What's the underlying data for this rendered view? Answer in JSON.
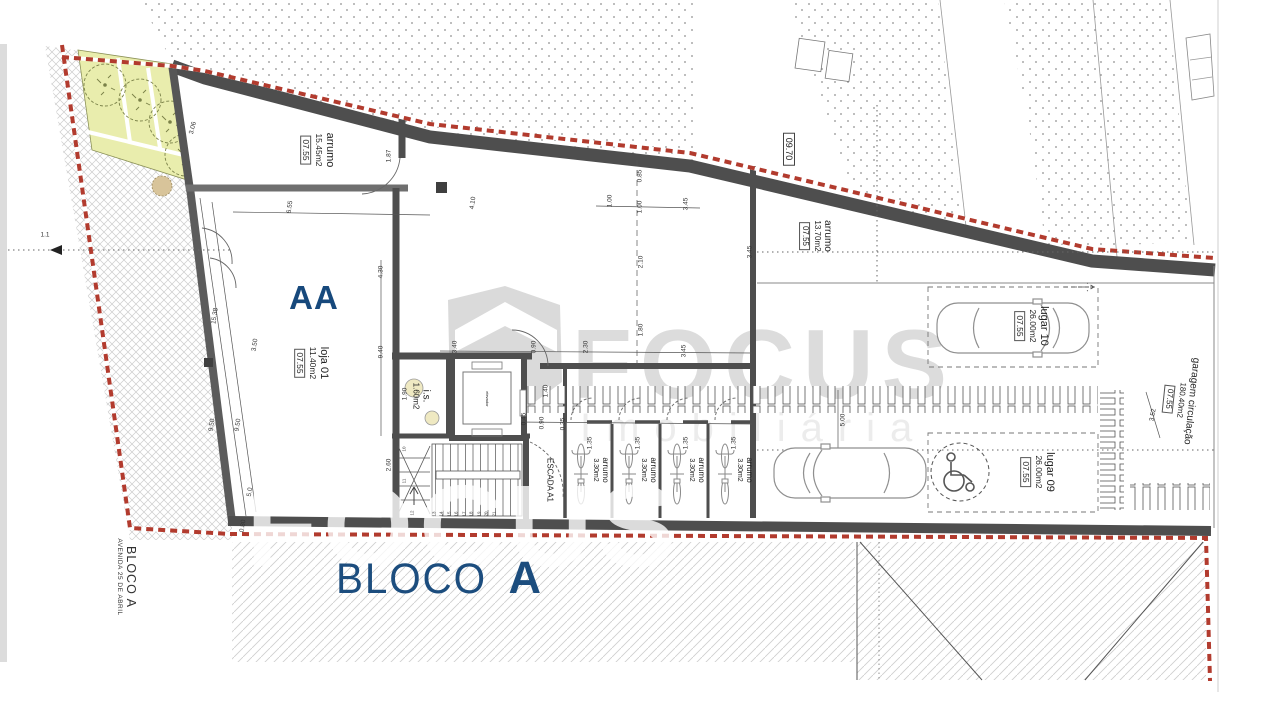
{
  "labels": {
    "block_marker": "AA",
    "bloco": {
      "word": "BLOCO",
      "letter": "A"
    },
    "street_vertical": {
      "line1": "BLOCO A",
      "line2": "AVENIDA 25 DE ABRIL"
    },
    "level_box": "09.70",
    "street_ref": "1.1"
  },
  "rooms": {
    "storage_top_left": {
      "name": "arrumo",
      "area": "15.45m2",
      "code": "07.55"
    },
    "shop": {
      "name": "loja 01",
      "area": "11.40m2",
      "code": "07.55"
    },
    "wc": {
      "name": "i.s.",
      "area": "1.60m2"
    },
    "elevator": {
      "name": "elevador"
    },
    "stairs": {
      "name": "ESCADA A1"
    },
    "storage_right": {
      "name": "arrumo",
      "area": "13.70m2",
      "code": "07.55"
    },
    "bike_storage": [
      {
        "name": "arrumo",
        "area": "3.30m2"
      },
      {
        "name": "arrumo",
        "area": "3.30m2"
      },
      {
        "name": "arrumo",
        "area": "3.30m2"
      },
      {
        "name": "arrumo",
        "area": "3.30m2"
      }
    ],
    "parking_10": {
      "name": "lugar 10",
      "area": "26.00m2",
      "code": "07.55"
    },
    "parking_09": {
      "name": "lugar 09",
      "area": "26.00m2",
      "code": "07.55"
    },
    "garage": {
      "name": "garagem circulação",
      "area": "180.40m2",
      "code": "07.55"
    }
  },
  "watermark": {
    "brand": "FOCUS",
    "tagline": "Imobiliária"
  },
  "dimensions": [
    {
      "t": "3.06",
      "x": 193,
      "y": 128,
      "r": -76
    },
    {
      "t": "6.55",
      "x": 290,
      "y": 207,
      "r": -82
    },
    {
      "t": "4.10",
      "x": 473,
      "y": 203,
      "r": -82
    },
    {
      "t": "1.87",
      "x": 389,
      "y": 156,
      "r": -90
    },
    {
      "t": "0.85",
      "x": 640,
      "y": 176,
      "r": -90
    },
    {
      "t": "1.00",
      "x": 610,
      "y": 201,
      "r": -90
    },
    {
      "t": "1.00",
      "x": 640,
      "y": 207,
      "r": -90
    },
    {
      "t": "3.45",
      "x": 686,
      "y": 204,
      "r": -90
    },
    {
      "t": "2.10",
      "x": 641,
      "y": 262,
      "r": -90
    },
    {
      "t": "1.80",
      "x": 641,
      "y": 330,
      "r": -90
    },
    {
      "t": "3.45",
      "x": 750,
      "y": 252,
      "r": -90
    },
    {
      "t": "4.30",
      "x": 381,
      "y": 272,
      "r": -90
    },
    {
      "t": "9.40",
      "x": 381,
      "y": 352,
      "r": -90
    },
    {
      "t": "3.40",
      "x": 455,
      "y": 347,
      "r": -90
    },
    {
      "t": "0.90",
      "x": 534,
      "y": 347,
      "r": -90
    },
    {
      "t": "2.30",
      "x": 586,
      "y": 347,
      "r": -90
    },
    {
      "t": "3.45",
      "x": 684,
      "y": 351,
      "r": -90
    },
    {
      "t": "1.90",
      "x": 405,
      "y": 394,
      "r": -90
    },
    {
      "t": "1.40",
      "x": 546,
      "y": 391,
      "r": -90
    },
    {
      "t": "0.45",
      "x": 524,
      "y": 419,
      "r": -90
    },
    {
      "t": "0.90",
      "x": 542,
      "y": 423,
      "r": -90
    },
    {
      "t": "0.35",
      "x": 563,
      "y": 424,
      "r": -90
    },
    {
      "t": "1.35",
      "x": 590,
      "y": 443,
      "r": -90
    },
    {
      "t": "1.35",
      "x": 638,
      "y": 443,
      "r": -90
    },
    {
      "t": "1.35",
      "x": 686,
      "y": 443,
      "r": -90
    },
    {
      "t": "1.35",
      "x": 734,
      "y": 443,
      "r": -90
    },
    {
      "t": "2.60",
      "x": 389,
      "y": 465,
      "r": -90
    },
    {
      "t": "15.38",
      "x": 215,
      "y": 316,
      "r": -81
    },
    {
      "t": "9.50",
      "x": 212,
      "y": 425,
      "r": -81
    },
    {
      "t": "9.50",
      "x": 238,
      "y": 425,
      "r": -81
    },
    {
      "t": "3.50",
      "x": 255,
      "y": 345,
      "r": -81
    },
    {
      "t": "5.0",
      "x": 250,
      "y": 492,
      "r": -81
    },
    {
      "t": "0.80",
      "x": 243,
      "y": 526,
      "r": -81
    },
    {
      "t": "5.00",
      "x": 843,
      "y": 420,
      "r": -90
    },
    {
      "t": "3.52",
      "x": 1153,
      "y": 415,
      "r": -80
    }
  ],
  "stair_steps": [
    {
      "n": "10",
      "x": 404,
      "y": 449
    },
    {
      "n": "11",
      "x": 404,
      "y": 481
    },
    {
      "n": "12",
      "x": 412,
      "y": 513
    },
    {
      "n": "13",
      "x": 434,
      "y": 514
    },
    {
      "n": "14",
      "x": 441,
      "y": 514
    },
    {
      "n": "15",
      "x": 449,
      "y": 514
    },
    {
      "n": "16",
      "x": 456,
      "y": 514
    },
    {
      "n": "17",
      "x": 464,
      "y": 514
    },
    {
      "n": "18",
      "x": 471,
      "y": 514
    },
    {
      "n": "19",
      "x": 479,
      "y": 514
    },
    {
      "n": "20",
      "x": 486,
      "y": 514
    },
    {
      "n": "21",
      "x": 494,
      "y": 514
    }
  ],
  "colors": {
    "navy": "#17497c",
    "boundary_red": "#b23b2e",
    "wall": "#4e4e4e",
    "garden": "#e9edad",
    "hatch": "#cfcfcf",
    "watermark": "#dcdcdc"
  }
}
